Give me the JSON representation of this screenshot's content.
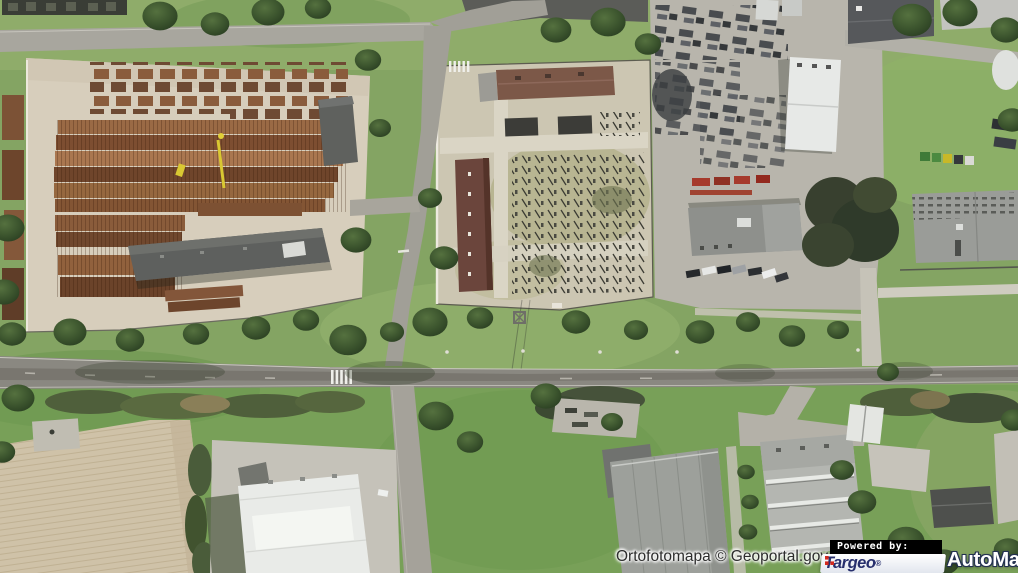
{
  "map": {
    "type": "orthophoto-aerial",
    "attribution": "Ortofotomapa © Geoportal.gov.pl"
  },
  "branding": {
    "powered_by_label": "Powered by:",
    "targeo": {
      "name": "Targeo",
      "reg_mark": "®",
      "text_color": "#272f6d",
      "accent_color": "#d42a1e",
      "bg_color": "#ffffff"
    },
    "automapa": {
      "name": "AutoMapa",
      "reg_mark": "®",
      "text_color": "#ffffff",
      "outline_color": "#233050"
    }
  }
}
